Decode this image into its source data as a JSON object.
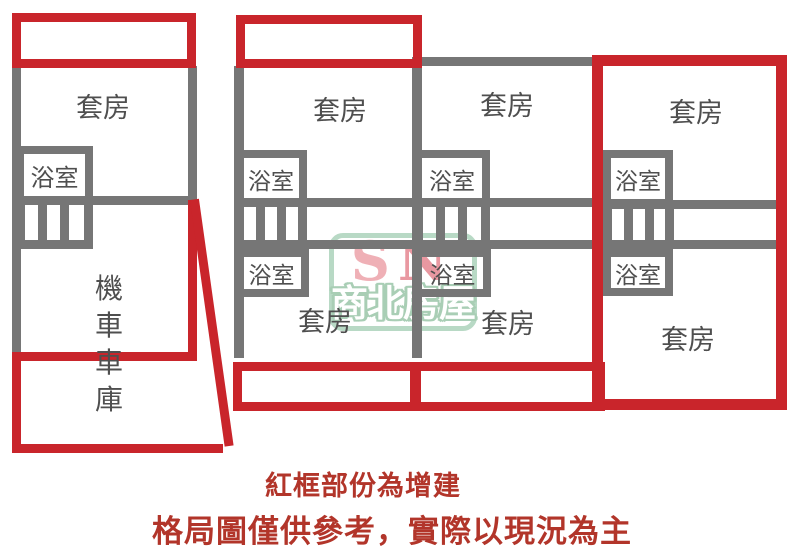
{
  "plan": {
    "left_unit": {
      "suite_label": "套房",
      "bath_label": "浴室",
      "garage_label_chars": [
        "機",
        "車",
        "車",
        "庫"
      ]
    },
    "middle_building": {
      "col1": {
        "suite_top": "套房",
        "bath_top": "浴室",
        "bath_bottom": "浴室",
        "suite_bottom": "套房"
      },
      "col2": {
        "suite_top": "套房",
        "bath_top": "浴室",
        "bath_bottom": "浴室",
        "suite_bottom": "套房"
      }
    },
    "right_unit": {
      "suite_top": "套房",
      "bath_top": "浴室",
      "bath_bottom": "浴室",
      "suite_bottom": "套房"
    }
  },
  "watermark": {
    "initial_s": "S",
    "initial_n": "N",
    "company": "商北房屋"
  },
  "legend": {
    "line1": "紅框部份為增建",
    "line2": "格局圖僅供參考，實際以現況為主"
  },
  "colors": {
    "wall_gray": "#767676",
    "addition_red": "#c9252b",
    "plan_label": "#4f4f4f",
    "legend_red": "#b2352a",
    "watermark_border_green": "#b5d8c2",
    "watermark_outline_green": "#a5ccb2",
    "watermark_s_pink": "#efacb3",
    "watermark_n_pink": "#e8939c"
  }
}
